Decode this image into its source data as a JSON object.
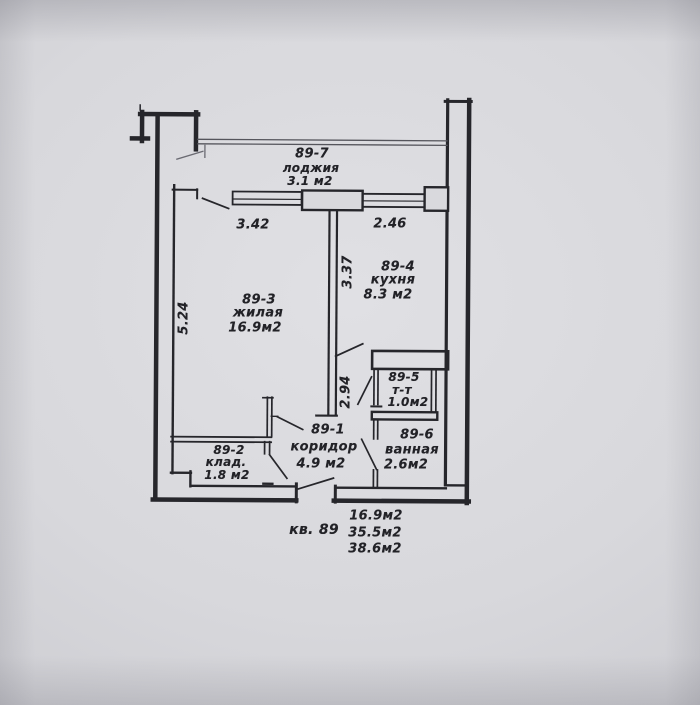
{
  "drawing": {
    "rooms": {
      "loggia": {
        "num": "89-7",
        "name": "лоджия",
        "area": "3.1 м2"
      },
      "living": {
        "num": "89-3",
        "name": "жилая",
        "area": "16.9м2"
      },
      "kitchen": {
        "num": "89-4",
        "name": "кухня",
        "area": "8.3 м2"
      },
      "toilet": {
        "num": "89-5",
        "name": "т-т",
        "area": "1.0м2"
      },
      "corridor": {
        "num": "89-1",
        "name": "коридор",
        "area": "4.9 м2"
      },
      "storage": {
        "num": "89-2",
        "name": "клад.",
        "area": "1.8 м2"
      },
      "bathroom": {
        "num": "89-6",
        "name": "ванная",
        "area": "2.6м2"
      }
    },
    "dimensions": {
      "living_width": "3.42",
      "kitchen_width": "2.46",
      "living_depth": "5.24",
      "kitchen_depth": "3.37",
      "corridor_depth": "2.94"
    },
    "summary": {
      "apartment": "кв. 89",
      "area_living": "16.9м2",
      "area_usable": "35.5м2",
      "area_total": "38.6м2"
    },
    "colors": {
      "paper": "#d8d8dc",
      "ink": "#26262b"
    }
  }
}
